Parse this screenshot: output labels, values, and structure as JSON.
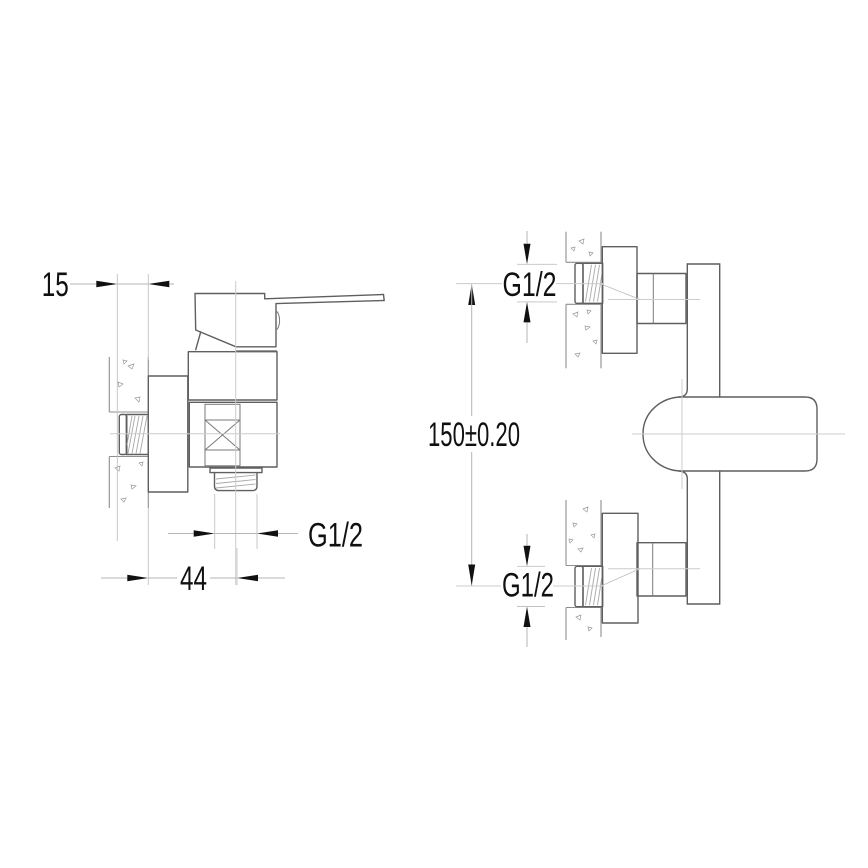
{
  "drawing": {
    "kind": "technical-dimension-drawing",
    "subject": "wall-mounted single-lever shower mixer, side view and front view",
    "dimensions": {
      "wall_offset": {
        "label": "15"
      },
      "outlet_offset": {
        "label": "44"
      },
      "outlet_thread": {
        "label": "G1/2"
      },
      "top_inlet_thread": {
        "label": "G1/2"
      },
      "inlet_spacing": {
        "label": "150±0.20"
      },
      "bottom_inlet_thread": {
        "label": "G1/2"
      }
    },
    "colors": {
      "background": "#ffffff",
      "part_line": "#5f5f5f",
      "wall_line": "#8e8e8e",
      "centerline": "#cccccc",
      "dimension_line": "#b4b4b4",
      "annotation": "#111111"
    }
  }
}
